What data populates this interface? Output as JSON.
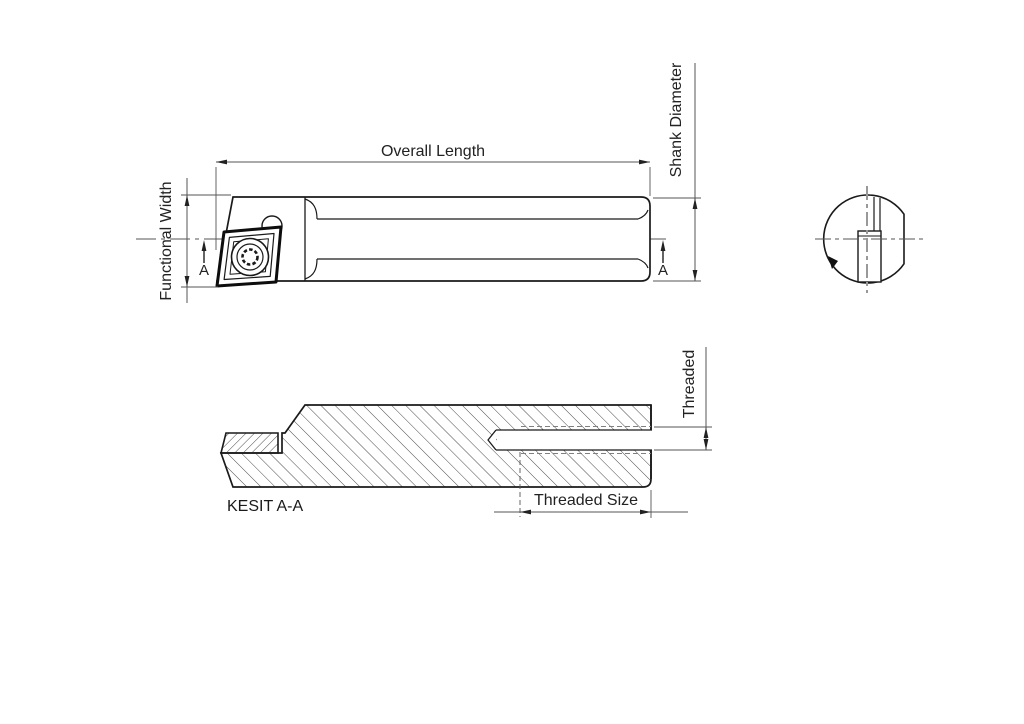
{
  "drawing": {
    "type": "technical-drawing",
    "subject": "boring bar tool holder with indexable insert",
    "labels": {
      "overall_length": "Overall Length",
      "shank_diameter": "Shank Diameter",
      "functional_width": "Functional Width",
      "section_marker": "A",
      "section_title": "KESIT A-A",
      "threaded": "Threaded",
      "threaded_size": "Threaded Size"
    },
    "colors": {
      "background": "#ffffff",
      "outline": "#1a1a1a",
      "dimension": "#555555",
      "centerline": "#666666",
      "hidden_dashed": "#808080",
      "hatch": "#4a4a4a",
      "text": "#222222"
    }
  }
}
